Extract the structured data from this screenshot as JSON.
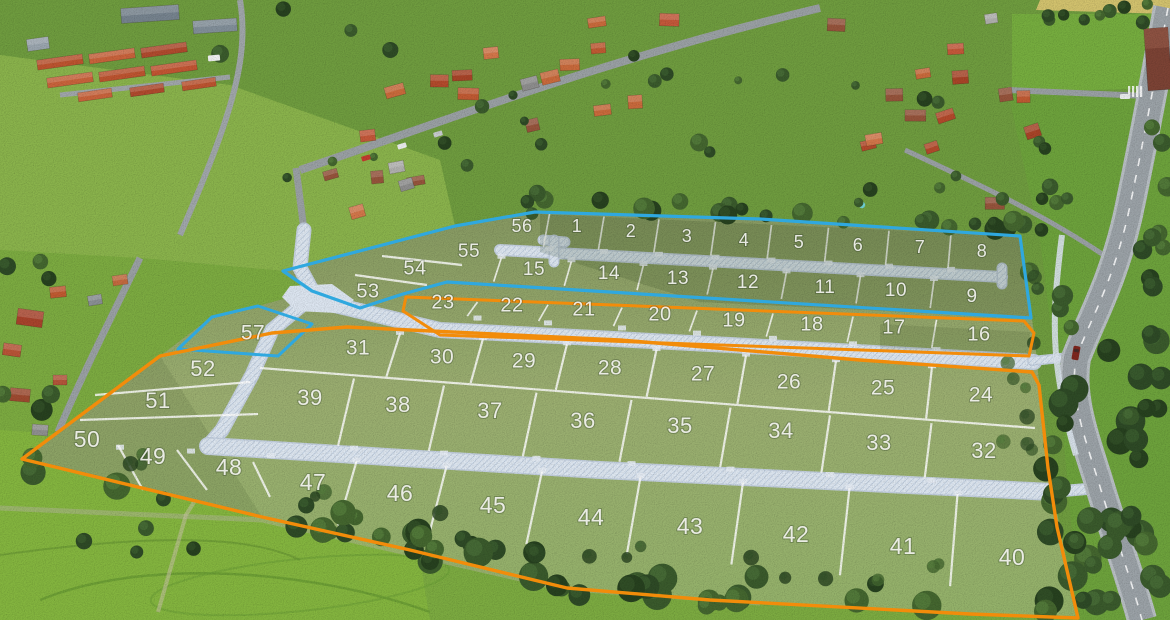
{
  "map": {
    "phase_colors": {
      "blue": "#2FA8DF",
      "orange": "#F28C0A"
    },
    "plots": [
      {
        "n": 1,
        "label": "1",
        "x": 577,
        "y": 227
      },
      {
        "n": 2,
        "label": "2",
        "x": 631,
        "y": 232
      },
      {
        "n": 3,
        "label": "3",
        "x": 687,
        "y": 237
      },
      {
        "n": 4,
        "label": "4",
        "x": 744,
        "y": 241
      },
      {
        "n": 5,
        "label": "5",
        "x": 799,
        "y": 243
      },
      {
        "n": 6,
        "label": "6",
        "x": 858,
        "y": 246
      },
      {
        "n": 7,
        "label": "7",
        "x": 920,
        "y": 248
      },
      {
        "n": 8,
        "label": "8",
        "x": 982,
        "y": 252
      },
      {
        "n": 9,
        "label": "9",
        "x": 972,
        "y": 297
      },
      {
        "n": 10,
        "label": "10",
        "x": 896,
        "y": 291
      },
      {
        "n": 11,
        "label": "11",
        "x": 825,
        "y": 288
      },
      {
        "n": 12,
        "label": "12",
        "x": 748,
        "y": 283
      },
      {
        "n": 13,
        "label": "13",
        "x": 678,
        "y": 279
      },
      {
        "n": 14,
        "label": "14",
        "x": 609,
        "y": 274
      },
      {
        "n": 15,
        "label": "15",
        "x": 534,
        "y": 270
      },
      {
        "n": 16,
        "label": "16",
        "x": 979,
        "y": 335
      },
      {
        "n": 17,
        "label": "17",
        "x": 894,
        "y": 328
      },
      {
        "n": 18,
        "label": "18",
        "x": 812,
        "y": 325
      },
      {
        "n": 19,
        "label": "19",
        "x": 734,
        "y": 321
      },
      {
        "n": 20,
        "label": "20",
        "x": 660,
        "y": 315
      },
      {
        "n": 21,
        "label": "21",
        "x": 584,
        "y": 310
      },
      {
        "n": 22,
        "label": "22",
        "x": 512,
        "y": 306
      },
      {
        "n": 23,
        "label": "23",
        "x": 443,
        "y": 303
      },
      {
        "n": 24,
        "label": "24",
        "x": 981,
        "y": 396
      },
      {
        "n": 25,
        "label": "25",
        "x": 883,
        "y": 389
      },
      {
        "n": 26,
        "label": "26",
        "x": 789,
        "y": 383
      },
      {
        "n": 27,
        "label": "27",
        "x": 703,
        "y": 375
      },
      {
        "n": 28,
        "label": "28",
        "x": 610,
        "y": 369
      },
      {
        "n": 29,
        "label": "29",
        "x": 524,
        "y": 362
      },
      {
        "n": 30,
        "label": "30",
        "x": 442,
        "y": 358
      },
      {
        "n": 31,
        "label": "31",
        "x": 358,
        "y": 349
      },
      {
        "n": 32,
        "label": "32",
        "x": 984,
        "y": 452
      },
      {
        "n": 33,
        "label": "33",
        "x": 879,
        "y": 444
      },
      {
        "n": 34,
        "label": "34",
        "x": 781,
        "y": 432
      },
      {
        "n": 35,
        "label": "35",
        "x": 680,
        "y": 427
      },
      {
        "n": 36,
        "label": "36",
        "x": 583,
        "y": 422
      },
      {
        "n": 37,
        "label": "37",
        "x": 490,
        "y": 412
      },
      {
        "n": 38,
        "label": "38",
        "x": 398,
        "y": 406
      },
      {
        "n": 39,
        "label": "39",
        "x": 310,
        "y": 399
      },
      {
        "n": 40,
        "label": "40",
        "x": 1012,
        "y": 559
      },
      {
        "n": 41,
        "label": "41",
        "x": 903,
        "y": 548
      },
      {
        "n": 42,
        "label": "42",
        "x": 796,
        "y": 536
      },
      {
        "n": 43,
        "label": "43",
        "x": 690,
        "y": 528
      },
      {
        "n": 44,
        "label": "44",
        "x": 591,
        "y": 519
      },
      {
        "n": 45,
        "label": "45",
        "x": 493,
        "y": 507
      },
      {
        "n": 46,
        "label": "46",
        "x": 400,
        "y": 495
      },
      {
        "n": 47,
        "label": "47",
        "x": 313,
        "y": 484
      },
      {
        "n": 48,
        "label": "48",
        "x": 229,
        "y": 469
      },
      {
        "n": 49,
        "label": "49",
        "x": 153,
        "y": 458
      },
      {
        "n": 50,
        "label": "50",
        "x": 87,
        "y": 441
      },
      {
        "n": 51,
        "label": "51",
        "x": 158,
        "y": 402
      },
      {
        "n": 52,
        "label": "52",
        "x": 203,
        "y": 370
      },
      {
        "n": 53,
        "label": "53",
        "x": 368,
        "y": 292
      },
      {
        "n": 54,
        "label": "54",
        "x": 415,
        "y": 269
      },
      {
        "n": 55,
        "label": "55",
        "x": 469,
        "y": 252
      },
      {
        "n": 56,
        "label": "56",
        "x": 522,
        "y": 227
      },
      {
        "n": 57,
        "label": "57",
        "x": 253,
        "y": 334
      }
    ],
    "rows": {
      "A": {
        "plots": [
          56,
          1,
          2,
          3,
          4,
          5,
          6,
          7,
          8
        ],
        "top": [
          535,
          212,
          1020,
          236
        ],
        "bottom": [
          498,
          246,
          1002,
          272
        ],
        "font": 18,
        "lean": 0.45,
        "pad_side": "bottom",
        "skip_first": 0
      },
      "B": {
        "plots": [
          55,
          15,
          14,
          13,
          12,
          11,
          10,
          9
        ],
        "top": [
          498,
          256,
          1002,
          282
        ],
        "bottom": [
          447,
          280,
          1027,
          315
        ],
        "font": 19,
        "lean": 0.55,
        "pad_side": "top",
        "skip_first": 0
      },
      "C": {
        "plots": [
          23,
          22,
          21,
          20,
          19,
          18,
          17,
          16
        ],
        "top": [
          405,
          298,
          1024,
          322
        ],
        "bottom": [
          404,
          313,
          1030,
          356
        ],
        "font": 20,
        "lean": 0.7,
        "pad_side": "bottom",
        "skip_first": 0
      },
      "D": {
        "plots": [
          31,
          30,
          29,
          28,
          27,
          26,
          25,
          24
        ],
        "top": [
          347,
          329,
          1032,
          372
        ],
        "bottom": [
          260,
          368,
          1035,
          428
        ],
        "font": 21,
        "lean": 0.85,
        "pad_side": "top",
        "skip_first": 0
      },
      "E": {
        "plots": [
          39,
          38,
          37,
          36,
          35,
          34,
          33,
          32
        ],
        "top": [
          260,
          370,
          1035,
          430
        ],
        "bottom": [
          208,
          440,
          1052,
          487
        ],
        "font": 22,
        "lean": 1.0,
        "pad_side": "bottom",
        "skip_first": 0
      },
      "F": {
        "plots": [
          50,
          49,
          48,
          47,
          46,
          45,
          44,
          43,
          42,
          41,
          40
        ],
        "top": [
          208,
          452,
          1052,
          498
        ],
        "bottom": [
          230,
          516,
          1078,
          600
        ],
        "font": 23,
        "lean": 1.15,
        "pad_side": "top",
        "skip_first": 3
      }
    },
    "single_fonts": {
      "57": 21,
      "54": 20,
      "53": 20,
      "52": 22,
      "51": 22
    },
    "extra_dividers": [
      [
        118,
        445,
        143,
        490
      ],
      [
        177,
        450,
        207,
        490
      ],
      [
        253,
        462,
        270,
        497
      ],
      [
        95,
        395,
        250,
        382
      ],
      [
        80,
        420,
        258,
        414
      ],
      [
        355,
        275,
        427,
        285
      ],
      [
        382,
        256,
        462,
        265
      ],
      [
        260,
        368,
        1035,
        428
      ]
    ],
    "boundaries": {
      "blue_main": [
        [
          283,
          271
        ],
        [
          455,
          226
        ],
        [
          535,
          212
        ],
        [
          760,
          219
        ],
        [
          1020,
          236
        ],
        [
          1031,
          318
        ],
        [
          447,
          282
        ],
        [
          403,
          294
        ],
        [
          360,
          308
        ],
        [
          312,
          291
        ]
      ],
      "blue_plot57": [
        [
          258,
          306
        ],
        [
          312,
          324
        ],
        [
          278,
          356
        ],
        [
          178,
          349
        ],
        [
          212,
          317
        ]
      ],
      "orange_strip": [
        [
          406,
          297
        ],
        [
          1024,
          321
        ],
        [
          1034,
          333
        ],
        [
          1029,
          356
        ],
        [
          440,
          335
        ],
        [
          403,
          311
        ]
      ],
      "orange_main": [
        [
          160,
          356
        ],
        [
          272,
          333
        ],
        [
          347,
          327
        ],
        [
          620,
          340
        ],
        [
          860,
          360
        ],
        [
          1032,
          372
        ],
        [
          1039,
          385
        ],
        [
          1048,
          468
        ],
        [
          1057,
          527
        ],
        [
          1078,
          618
        ],
        [
          970,
          614
        ],
        [
          710,
          600
        ],
        [
          567,
          588
        ],
        [
          410,
          550
        ],
        [
          262,
          517
        ],
        [
          22,
          459
        ]
      ]
    }
  }
}
